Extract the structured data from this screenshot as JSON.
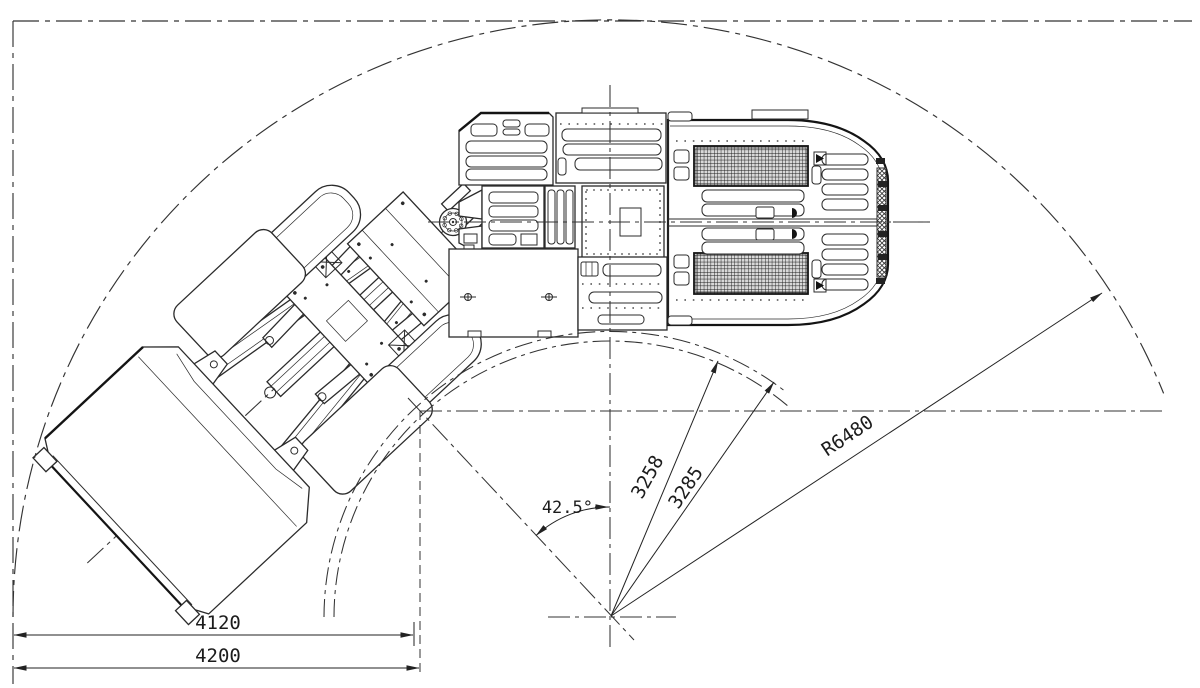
{
  "dimensions": {
    "aisle_width_inner": {
      "label": "4120"
    },
    "aisle_width_outer": {
      "label": "4200"
    },
    "articulation_angle": {
      "label": "42.5°"
    },
    "inner_radius_a": {
      "label": "3258"
    },
    "inner_radius_b": {
      "label": "3285"
    },
    "outer_turning_radius": {
      "label": "R6480"
    }
  },
  "colors": {
    "line": "#2b2b2b",
    "heavy_line": "#141414",
    "background": "#ffffff"
  }
}
